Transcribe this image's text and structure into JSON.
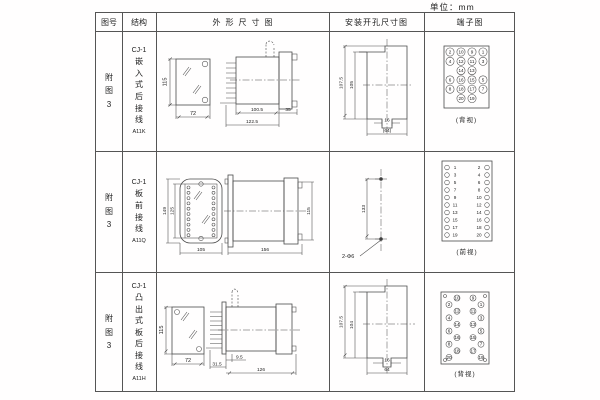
{
  "unit_label": "单位：mm",
  "header": {
    "fig_no": "图号",
    "structure": "结构",
    "outline": "外形尺寸图",
    "mounting": "安装开孔尺寸图",
    "terminal": "端子图"
  },
  "rows": [
    {
      "fig_no": "附图3",
      "structure": {
        "series": "CJ-1",
        "desc": "嵌入式后接线",
        "code": "A11K"
      },
      "outline_dims": {
        "front_height": "115",
        "front_width": "72",
        "side_body": "100.5",
        "side_total": "122.5",
        "side_flange": "35"
      },
      "mounting_dims": {
        "outer_height": "107.5",
        "inner_height": "105",
        "slot_width": "16",
        "overall_width": "(64)"
      },
      "terminal": {
        "view_label": "(背视)",
        "layout": "grid",
        "items": [
          [
            2,
            0,
            0
          ],
          [
            10,
            1,
            0
          ],
          [
            9,
            2,
            0
          ],
          [
            1,
            3,
            0
          ],
          [
            4,
            0,
            1
          ],
          [
            12,
            1,
            1
          ],
          [
            11,
            2,
            1
          ],
          [
            3,
            3,
            1
          ],
          [
            14,
            1,
            2
          ],
          [
            13,
            2,
            2
          ],
          [
            6,
            0,
            3
          ],
          [
            16,
            1,
            3
          ],
          [
            15,
            2,
            3
          ],
          [
            5,
            3,
            3
          ],
          [
            8,
            0,
            4
          ],
          [
            18,
            1,
            4
          ],
          [
            17,
            2,
            4
          ],
          [
            7,
            3,
            4
          ],
          [
            20,
            1,
            5
          ],
          [
            19,
            2,
            5
          ]
        ]
      }
    },
    {
      "fig_no": "附图3",
      "structure": {
        "series": "CJ-1",
        "desc": "板前接线",
        "code": "A11Q"
      },
      "outline_dims": {
        "front_outer_height": "149",
        "front_inner_height": "125",
        "front_width": "105",
        "side_length": "156",
        "side_height": "115"
      },
      "mounting_dims": {
        "hole_spacing": "133",
        "holes": "2-Φ6"
      },
      "terminal": {
        "view_label": "(前视)",
        "layout": "rows",
        "pairs": [
          [
            1,
            2
          ],
          [
            3,
            4
          ],
          [
            5,
            6
          ],
          [
            7,
            8
          ],
          [
            9,
            10
          ],
          [
            11,
            12
          ],
          [
            13,
            14
          ],
          [
            15,
            16
          ],
          [
            17,
            18
          ],
          [
            19,
            20
          ]
        ]
      }
    },
    {
      "fig_no": "附图3",
      "structure": {
        "series": "CJ-1",
        "desc": "凸出式板后接线",
        "code": "A11H"
      },
      "outline_dims": {
        "front_height": "115",
        "front_width": "72",
        "side_plate": "9.5",
        "side_pins": "31.5",
        "side_length": "126"
      },
      "mounting_dims": {
        "outer_height": "107.5",
        "inner_height": "104",
        "slot_width": "16",
        "overall_width": "64"
      },
      "terminal": {
        "view_label": "(背视)",
        "layout": "staggered",
        "items": [
          [
            10,
            1,
            0
          ],
          [
            9,
            2,
            0
          ],
          [
            2,
            0,
            1
          ],
          [
            1,
            3,
            1
          ],
          [
            12,
            1,
            2
          ],
          [
            11,
            2,
            2
          ],
          [
            4,
            0,
            3
          ],
          [
            3,
            3,
            3
          ],
          [
            14,
            1,
            4
          ],
          [
            13,
            2,
            4
          ],
          [
            6,
            0,
            5
          ],
          [
            5,
            3,
            5
          ],
          [
            16,
            1,
            6
          ],
          [
            15,
            2,
            6
          ],
          [
            8,
            0,
            7
          ],
          [
            7,
            3,
            7
          ],
          [
            18,
            1,
            8
          ],
          [
            17,
            2,
            8
          ],
          [
            20,
            0,
            9
          ],
          [
            19,
            3,
            9
          ]
        ]
      }
    }
  ]
}
